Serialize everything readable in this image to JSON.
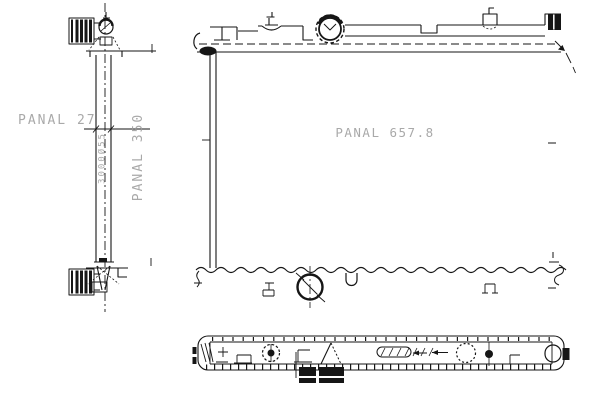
{
  "drawing": {
    "type": "radiator-technical-line-drawing",
    "views": [
      "side-view",
      "front-view",
      "bottom-view"
    ],
    "labels": {
      "core_depth": "PANAL 27",
      "core_height": "PANAL 350",
      "core_width": "PANAL 657.8",
      "tube_marking": "3000Ø55"
    },
    "colors": {
      "line": "#161616",
      "label": "#9b9b9b",
      "background": "#ffffff"
    }
  }
}
